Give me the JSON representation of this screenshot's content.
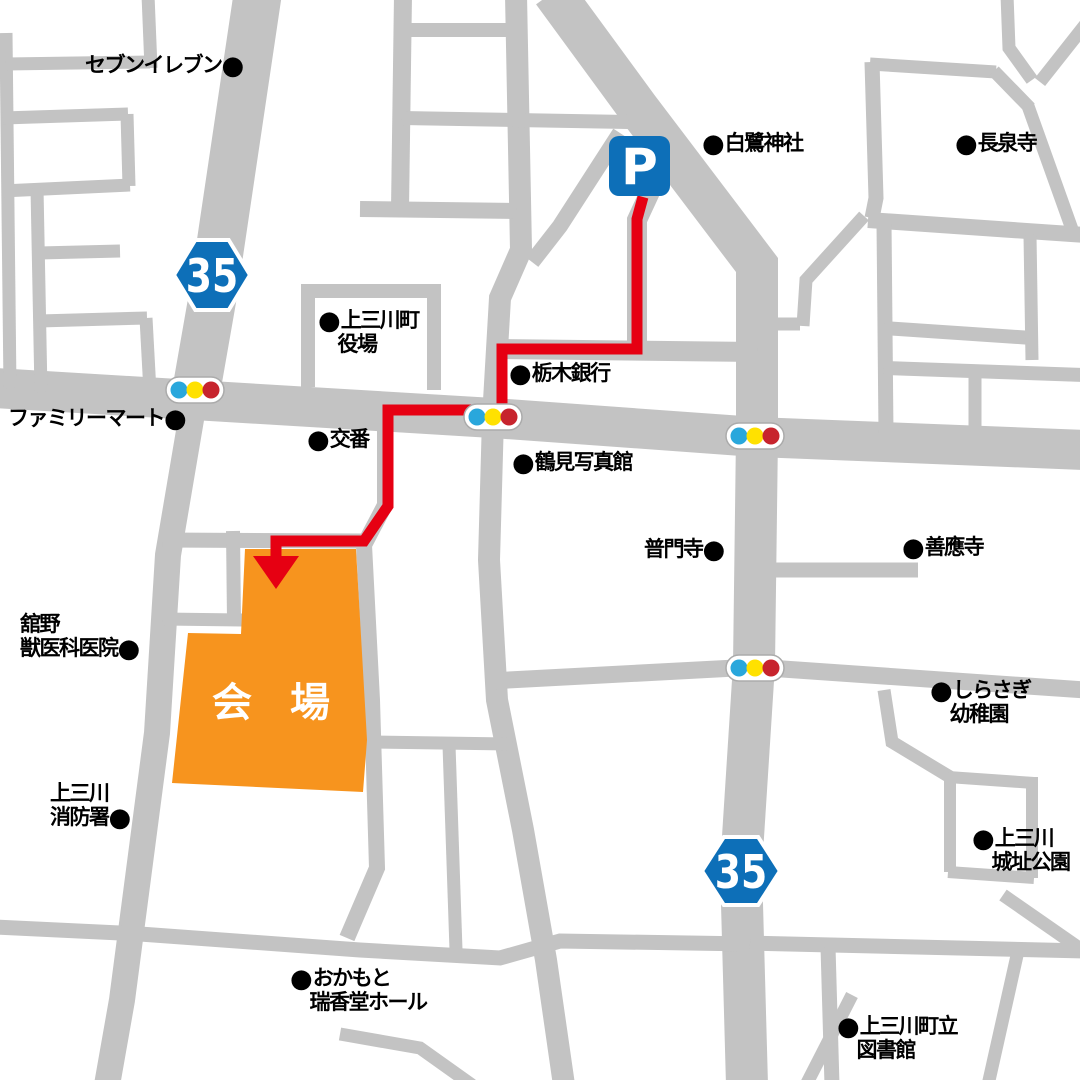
{
  "map": {
    "background": "#ffffff",
    "road_color": "#c3c3c3",
    "route_color": "#e60012",
    "route_width": 11,
    "blue": "#0d6fb8",
    "signal_colors": [
      "#29a7dc",
      "#ffe100",
      "#c7242d"
    ],
    "signal_body": "#ffffff",
    "signal_border": "#ababab",
    "roads": [
      {
        "d": "M 258 -8 L 213 295 L 196 392",
        "w": 48
      },
      {
        "d": "M 553 -8 L 638 108 L 757 265 L 757 435 L 754 665 L 741 868 L 747 1085",
        "w": 42
      },
      {
        "d": "M -5 388 L 493 418 L 756 437 L 1085 450",
        "w": 40
      },
      {
        "d": "M 196 390 L 168 555 L 157 733 L 122 1000 L 107 1085",
        "w": 26
      },
      {
        "d": "M 516 -5 L 521 250 L 500 298 L 493 418",
        "w": 22
      },
      {
        "d": "M 493 418 L 489 560 L 497 700 L 523 830 L 546 960 L 564 1085",
        "w": 22
      },
      {
        "d": "M 650 192 L 637 220 L 637 352",
        "w": 20
      },
      {
        "d": "M 500 349 L 757 352",
        "w": 20
      },
      {
        "d": "M 620 133 L 560 226 L 532 262",
        "w": 16
      },
      {
        "d": "M 403 -5 L 400 209",
        "w": 18
      },
      {
        "d": "M 403 30 L 517 30",
        "w": 14
      },
      {
        "d": "M 402 118 L 628 122",
        "w": 14
      },
      {
        "d": "M 360 209 L 516 211",
        "w": 16
      },
      {
        "d": "M 308 288 L 308 387",
        "w": 14
      },
      {
        "d": "M 434 292 L 434 390",
        "w": 14
      },
      {
        "d": "M 301 291 L 441 291",
        "w": 14
      },
      {
        "d": "M 6 33 L 10 388",
        "w": 13
      },
      {
        "d": "M 6 64 L 150 62",
        "w": 13
      },
      {
        "d": "M 148 -5 L 151 68",
        "w": 13
      },
      {
        "d": "M 3 118 L 128 114",
        "w": 13
      },
      {
        "d": "M 127 114 L 129 186",
        "w": 13
      },
      {
        "d": "M 2 191 L 130 185",
        "w": 13
      },
      {
        "d": "M 37 188 L 41 392",
        "w": 13
      },
      {
        "d": "M 39 253 L 120 251",
        "w": 13
      },
      {
        "d": "M 39 321 L 147 318",
        "w": 13
      },
      {
        "d": "M 146 318 L 150 392",
        "w": 13
      },
      {
        "d": "M 872 62 L 876 198 L 872 218",
        "w": 15
      },
      {
        "d": "M 868 220 L 1085 235",
        "w": 16
      },
      {
        "d": "M 864 216 L 806 280 L 803 326",
        "w": 13
      },
      {
        "d": "M 800 324 L 770 324",
        "w": 13
      },
      {
        "d": "M 884 222 L 886 434",
        "w": 15
      },
      {
        "d": "M 884 328 L 1032 338",
        "w": 14
      },
      {
        "d": "M 1030 235 L 1032 360",
        "w": 13
      },
      {
        "d": "M 884 368 L 1085 375",
        "w": 14
      },
      {
        "d": "M 975 366 L 975 442",
        "w": 13
      },
      {
        "d": "M 870 64 L 996 72",
        "w": 13
      },
      {
        "d": "M 994 71 L 1030 108",
        "w": 13
      },
      {
        "d": "M 1028 106 L 1073 232",
        "w": 13
      },
      {
        "d": "M 1007 -5 L 1009 48 L 1032 80",
        "w": 13
      },
      {
        "d": "M 1085 25 L 1040 82",
        "w": 13
      },
      {
        "d": "M 770 570 L 918 570",
        "w": 15
      },
      {
        "d": "M 490 681 L 754 667 L 1085 690",
        "w": 17
      },
      {
        "d": "M 884 690 L 892 742 L 950 777",
        "w": 13
      },
      {
        "d": "M 948 777 L 1034 783",
        "w": 12
      },
      {
        "d": "M 950 777 L 950 872",
        "w": 12
      },
      {
        "d": "M 948 872 L 1034 878",
        "w": 12
      },
      {
        "d": "M 1032 777 L 1032 878",
        "w": 12
      },
      {
        "d": "M 1003 895 L 1085 952",
        "w": 13
      },
      {
        "d": "M 746 943 L 1085 951",
        "w": 15
      },
      {
        "d": "M 828 947 L 832 1085",
        "w": 15
      },
      {
        "d": "M 1018 951 L 988 1085",
        "w": 13
      },
      {
        "d": "M 852 995 L 806 1085",
        "w": 13
      },
      {
        "d": "M -5 927 L 140 934 L 360 950 L 500 958 L 560 941 L 750 944",
        "w": 15
      },
      {
        "d": "M 449 745 L 456 950",
        "w": 13
      },
      {
        "d": "M 370 742 L 512 744",
        "w": 13
      },
      {
        "d": "M 385 415 L 385 505 L 364 545 L 372 700 L 377 868 L 347 938",
        "w": 16
      },
      {
        "d": "M 163 540 L 366 541",
        "w": 15
      },
      {
        "d": "M 233 531 L 234 621",
        "w": 14
      },
      {
        "d": "M 163 619 L 242 620",
        "w": 13
      },
      {
        "d": "M 340 1034 L 420 1048 L 472 1085",
        "w": 13
      }
    ],
    "venue": {
      "points": "245,549 356,549 367,740 363,792 172,783 188,633 241,634",
      "fill": "#f7941e",
      "label": "会 場",
      "label_color": "#ffffff",
      "label_x": 277,
      "label_y": 716,
      "label_size": 40
    },
    "route": {
      "points": "643,197 637,219 637,349 502,349 502,410 388,410 388,506 364,541 276,541 276,562",
      "arrow": "253,556 299,556 276,589"
    },
    "parking": {
      "x": 609,
      "y": 136,
      "w": 61,
      "h": 60,
      "rx": 10,
      "label": "P"
    },
    "shields": [
      {
        "cx": 212,
        "cy": 275,
        "w": 76,
        "h": 70,
        "label": "35"
      },
      {
        "cx": 741,
        "cy": 871,
        "w": 78,
        "h": 68,
        "label": "35"
      }
    ],
    "signals": [
      {
        "cx": 195,
        "cy": 390
      },
      {
        "cx": 493,
        "cy": 417
      },
      {
        "cx": 755,
        "cy": 436
      },
      {
        "cx": 755,
        "cy": 668
      }
    ],
    "labels": [
      {
        "id": "seven-eleven",
        "x": 85,
        "y": 53,
        "lines": [
          "セブンイレブン●"
        ]
      },
      {
        "id": "shirasagi-shrine",
        "x": 702,
        "y": 131,
        "lines": [
          "●白鷺神社"
        ]
      },
      {
        "id": "chosenji-temple",
        "x": 955,
        "y": 131,
        "lines": [
          "●長泉寺"
        ]
      },
      {
        "id": "kaminokawa-town-hall",
        "x": 318,
        "y": 308,
        "lines": [
          "●上三川町",
          "　役場"
        ]
      },
      {
        "id": "tochigi-bank",
        "x": 509,
        "y": 361,
        "lines": [
          "●栃木銀行"
        ]
      },
      {
        "id": "familymart",
        "x": 8,
        "y": 406,
        "lines": [
          "ファミリーマート●"
        ]
      },
      {
        "id": "koban-police-box",
        "x": 307,
        "y": 427,
        "lines": [
          "●交番"
        ]
      },
      {
        "id": "tsurumi-photo-studio",
        "x": 512,
        "y": 450,
        "lines": [
          "●鶴見写真館"
        ]
      },
      {
        "id": "fumonji-temple",
        "x": 644,
        "y": 537,
        "lines": [
          "普門寺●"
        ]
      },
      {
        "id": "zenoji-temple",
        "x": 902,
        "y": 535,
        "lines": [
          "●善應寺"
        ]
      },
      {
        "id": "tateno-vet-clinic",
        "x": 20,
        "y": 612,
        "lines": [
          "舘野",
          "獣医科医院●"
        ]
      },
      {
        "id": "shirasagi-kindergarten",
        "x": 930,
        "y": 678,
        "lines": [
          "●しらさぎ",
          "　幼稚園"
        ]
      },
      {
        "id": "fire-station",
        "x": 50,
        "y": 781,
        "lines": [
          "上三川",
          "消防署●"
        ]
      },
      {
        "id": "castle-ruins-park",
        "x": 972,
        "y": 826,
        "lines": [
          "●上三川",
          "　城址公園"
        ]
      },
      {
        "id": "okamoto-zuikodo-hall",
        "x": 290,
        "y": 966,
        "lines": [
          "●おかもと",
          "　瑞香堂ホール"
        ]
      },
      {
        "id": "town-library",
        "x": 837,
        "y": 1014,
        "lines": [
          "●上三川町立",
          "　図書館"
        ]
      }
    ]
  }
}
